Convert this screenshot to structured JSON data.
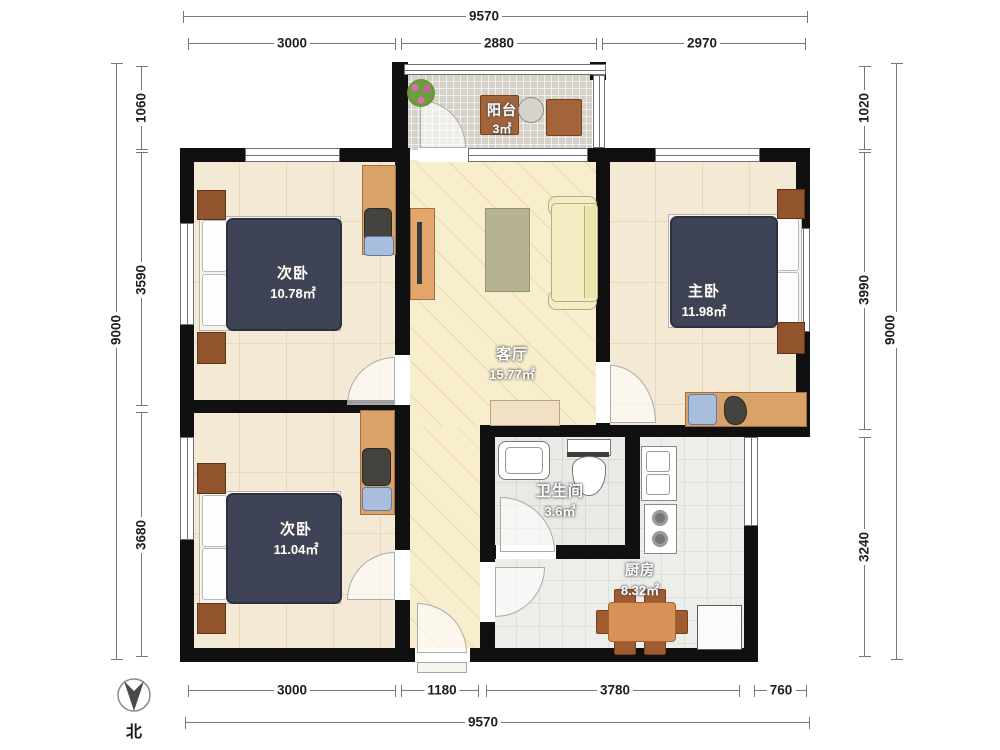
{
  "plan_title": "3-room floor plan",
  "rooms": [
    {
      "id": "balcony",
      "name": "阳台",
      "area": "3㎡"
    },
    {
      "id": "bedroom-top-left",
      "name": "次卧",
      "area": "10.78㎡"
    },
    {
      "id": "living-room",
      "name": "客厅",
      "area": "15.77㎡"
    },
    {
      "id": "master-bedroom",
      "name": "主卧",
      "area": "11.98㎡"
    },
    {
      "id": "bedroom-bottom-left",
      "name": "次卧",
      "area": "11.04㎡"
    },
    {
      "id": "bathroom",
      "name": "卫生间",
      "area": "3.6㎡"
    },
    {
      "id": "kitchen",
      "name": "厨房",
      "area": "8.32㎡"
    }
  ],
  "dimensions": {
    "top": {
      "total": "9570",
      "segments": [
        "3000",
        "2880",
        "2970"
      ]
    },
    "left": {
      "total": "9000",
      "segments": [
        "1060",
        "3590",
        "3680"
      ]
    },
    "right": {
      "total": "9000",
      "segments": [
        "1020",
        "3990",
        "3240"
      ]
    },
    "bottom": {
      "total": "9570",
      "segments": [
        "3000",
        "1180",
        "3780",
        "760"
      ]
    }
  },
  "compass": {
    "label": "北"
  },
  "colors": {
    "wall": "#101010",
    "bedroom_floor": "#f4e9d4",
    "living_floor": "#f8edcd",
    "balcony_floor": "#d6d1c8",
    "bath_floor": "#e9e9e6",
    "bed": "#3e4356",
    "wood_furniture": "#d9a268",
    "dining_wood": "#d9915a",
    "sofa": "#f2edc2"
  }
}
